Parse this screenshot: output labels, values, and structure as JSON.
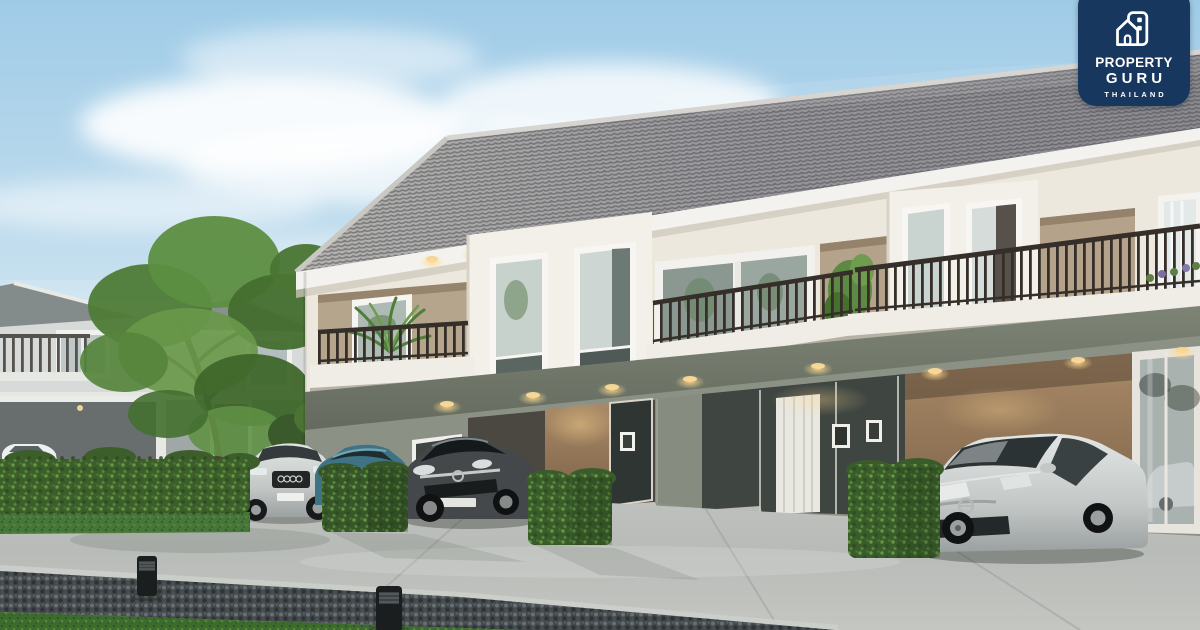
{
  "logo": {
    "line1": "PROPERTY",
    "line2": "GURU",
    "line3": "THAILAND",
    "badge_color": "#17375f",
    "text_color": "#ffffff",
    "icon": "house-building-icon"
  },
  "scene": {
    "type": "3d-architectural-rendering",
    "subject": "Row of modern two-storey townhouses with balconies, hedges, driveways and parked cars under a blue sky",
    "colors": {
      "sky_top": "#9fcbe7",
      "sky_horizon": "#eef5f8",
      "roof_tiles": "#9b9a97",
      "fascia_white": "#f3f2ee",
      "wall_upper_cream": "#ece8dd",
      "wall_accent_tan": "#b4a38a",
      "wall_lower_green_gray": "#8a9184",
      "railing_dark": "#352e29",
      "hedge_green": "#3c5e2a",
      "driveway_concrete": "#bcbfbb",
      "gravel_strip": "#44494b",
      "grass": "#3d6b2e",
      "downlight_warm": "#f7d9a0"
    },
    "objects": [
      {
        "name": "townhouse-row",
        "floors": 2,
        "visible_units": 4
      },
      {
        "name": "detached-house-background"
      },
      {
        "name": "large-tree"
      },
      {
        "name": "hedges",
        "count": 4
      },
      {
        "name": "bollard-lights",
        "count": 2
      },
      {
        "name": "car-white-carport",
        "color": "#eef0ef"
      },
      {
        "name": "car-silver-suv",
        "color": "#d3d6d5"
      },
      {
        "name": "car-teal-hatchback",
        "color": "#3e7386"
      },
      {
        "name": "car-dark-gray-coupe",
        "color": "#44484a"
      },
      {
        "name": "car-silver-coupe",
        "color": "#d4d8d7"
      }
    ]
  }
}
